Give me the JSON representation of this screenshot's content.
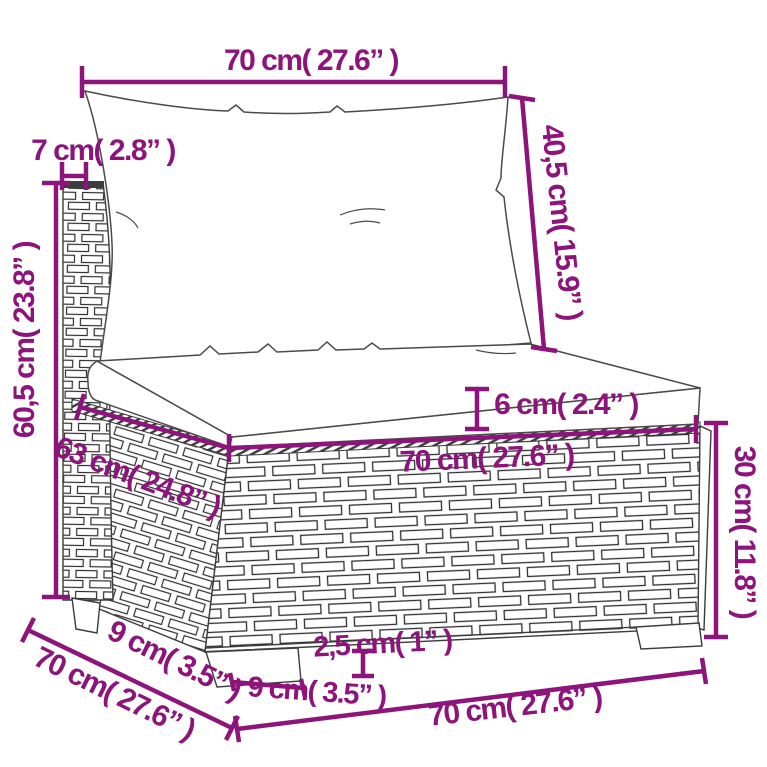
{
  "colors": {
    "dimension_text_and_lines": "#8c147a",
    "drawing_outline": "#3c3c3c",
    "background": "#ffffff"
  },
  "diagram": {
    "subject": "poly-rattan middle sofa section with back and seat cushions",
    "labels": {
      "back_cushion_width": "70 cm( 27.6” )",
      "back_frame_thickness": "7 cm( 2.8” )",
      "back_cushion_height": "40,5 cm( 15.9” )",
      "total_height": "60,5 cm( 23.8” )",
      "seat_cushion_thickness": "6 cm( 2.4” )",
      "seat_cushion_width": "70 cm( 27.6” )",
      "seat_depth": "63 cm( 24.8” )",
      "base_height": "30 cm( 11.8” )",
      "side_depth": "9 cm( 3.5” )",
      "total_depth": "70 cm( 27.6” )",
      "leg_height": "2,5 cm( 1” )",
      "leg_width": "9 cm( 3.5” )",
      "base_width": "70 cm( 27.6” )"
    }
  }
}
